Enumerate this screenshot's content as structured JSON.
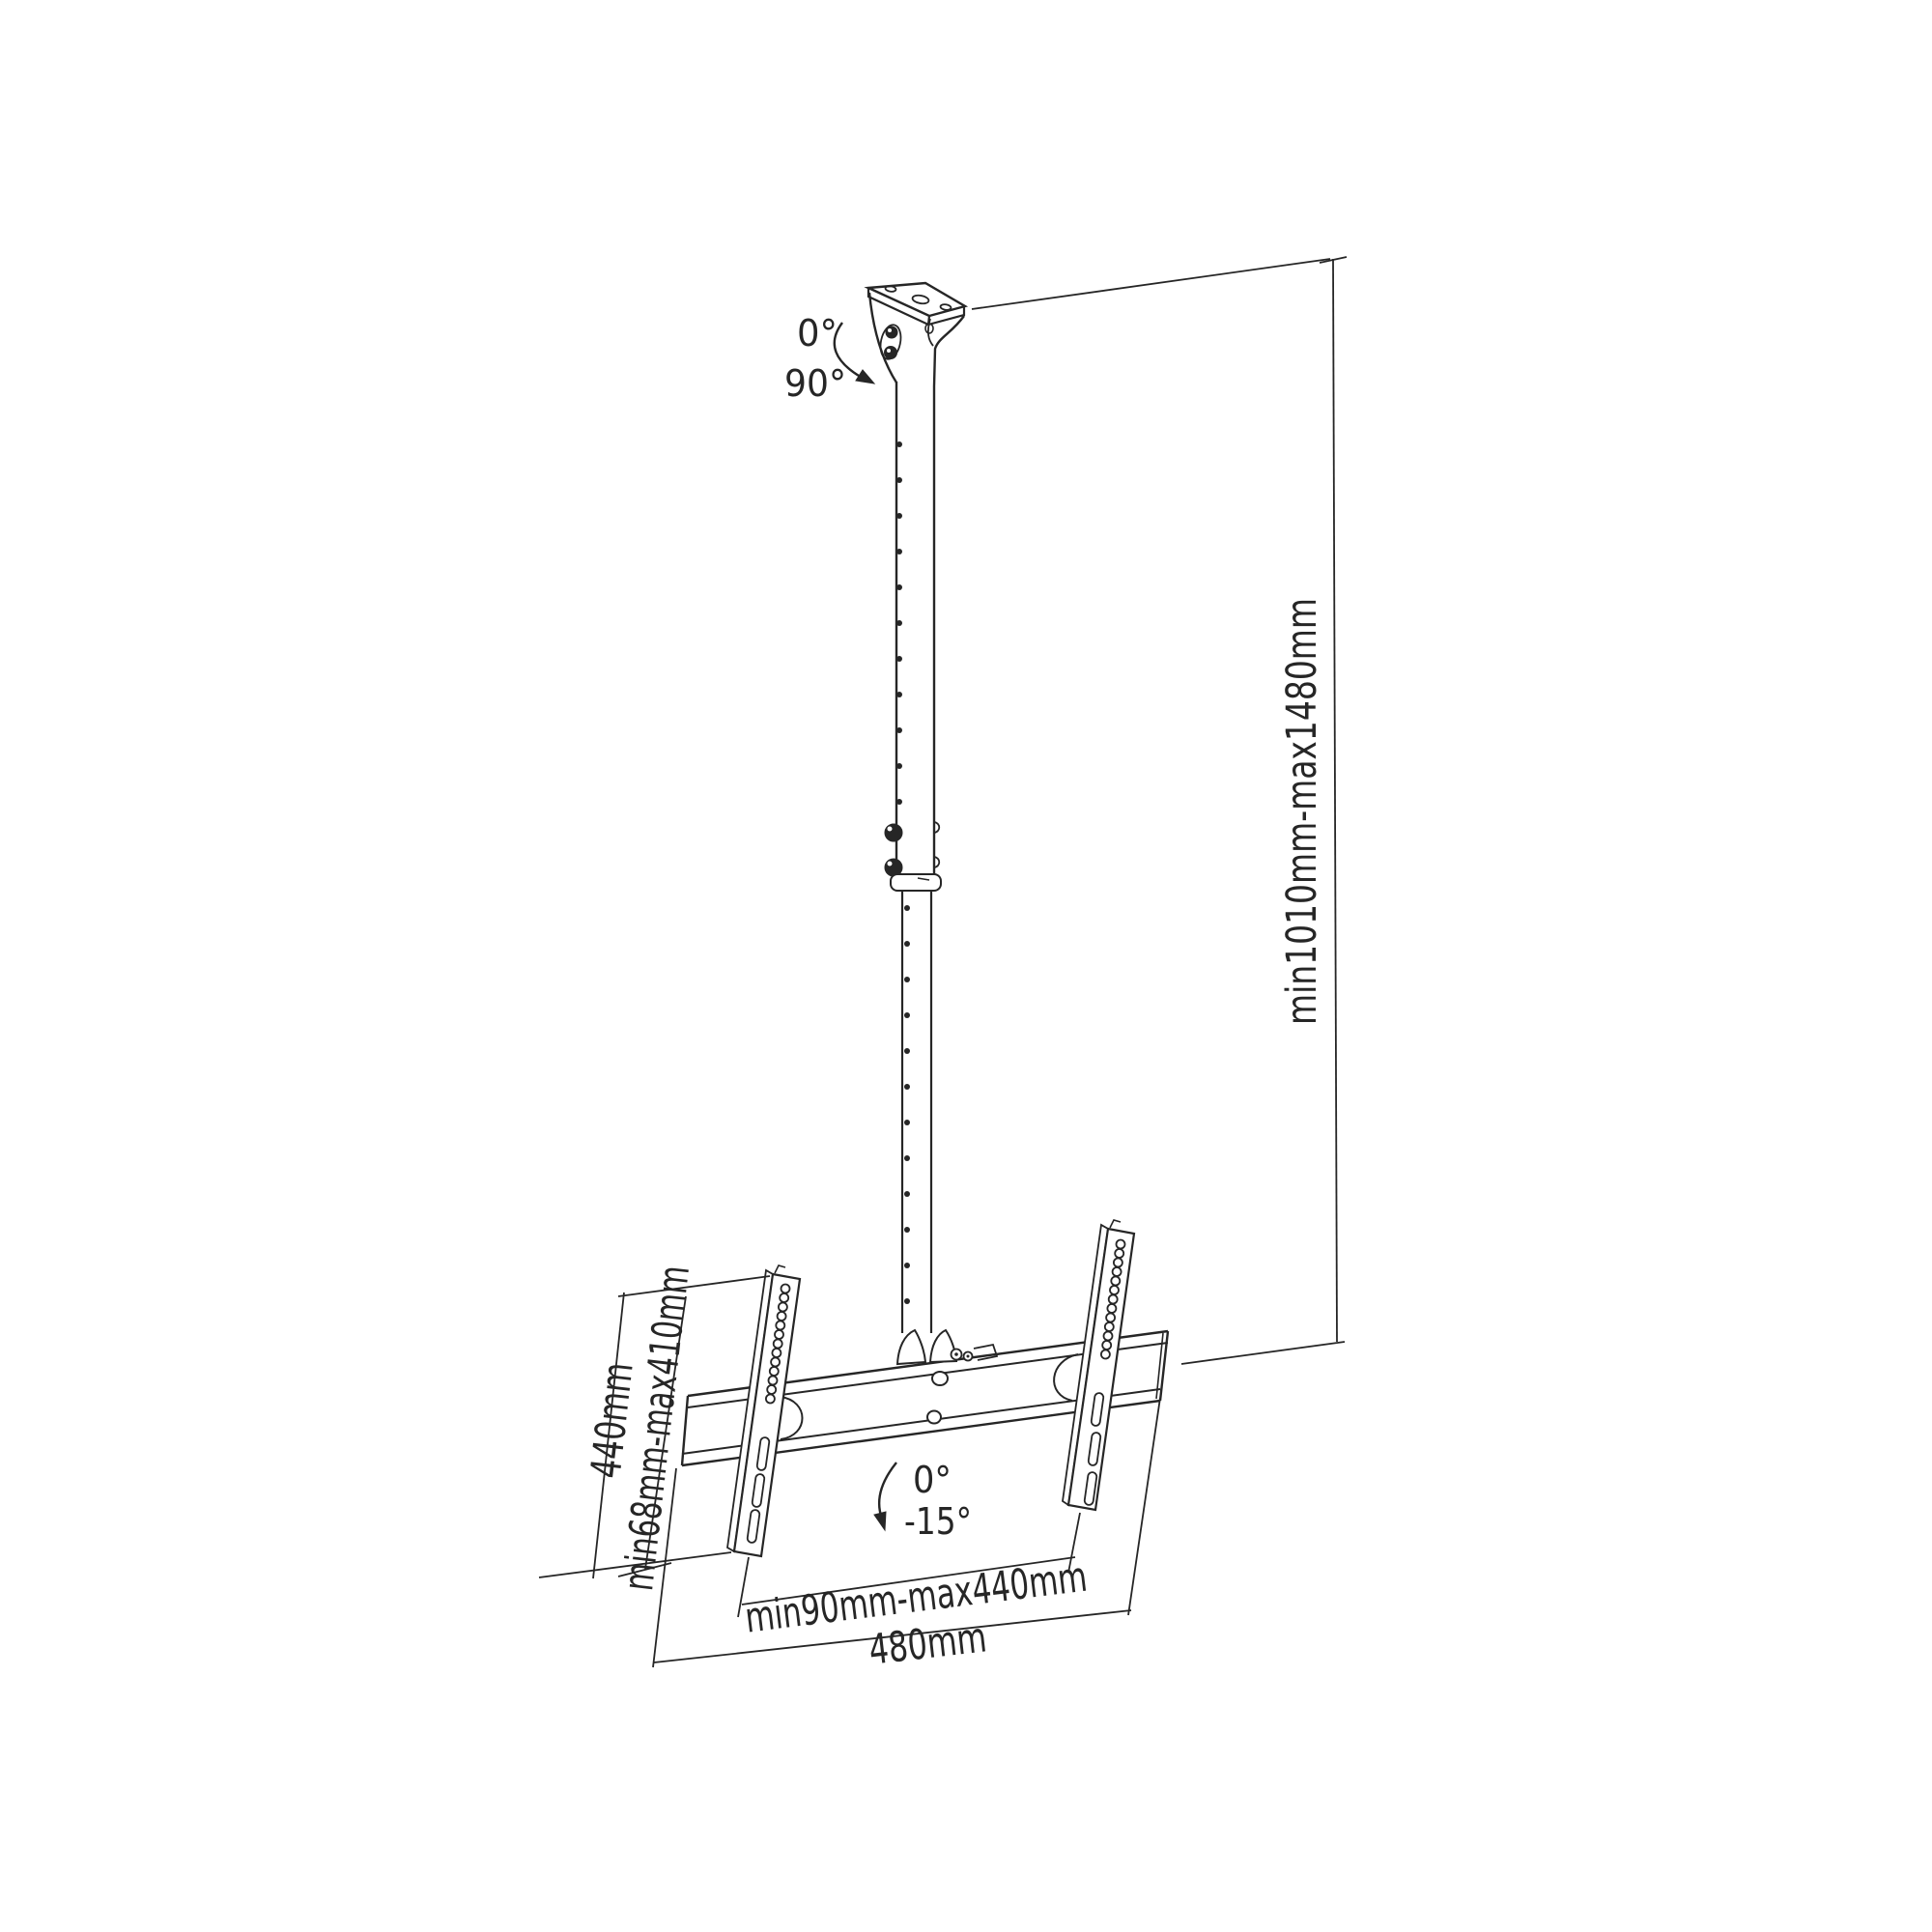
{
  "page": {
    "background": "#ffffff",
    "line_color": "#262626"
  },
  "diagram": {
    "type": "technical-drawing",
    "annotations": {
      "pole_tilt_min": "0°",
      "pole_tilt_max": "90°",
      "height_range": "min1010mm-max1480mm",
      "bracket_height": "440mm",
      "vesa_vertical_range": "min68mm-max410mm",
      "screen_tilt_min": "0°",
      "screen_tilt_max": "-15°",
      "vesa_horizontal_range": "min90mm-max440mm",
      "crossbar_width": "480mm"
    }
  }
}
